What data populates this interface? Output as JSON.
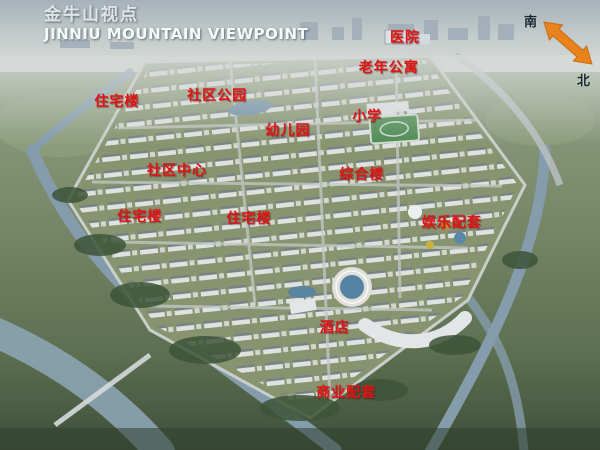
{
  "title": {
    "zh": "金牛山视点",
    "en": "JINNIU MOUNTAIN VIEWPOINT"
  },
  "compass": {
    "south": "南",
    "north": "北",
    "arrow_color": "#e8821c"
  },
  "labels": [
    {
      "id": "hospital",
      "text": "医院"
    },
    {
      "id": "senior-apartments",
      "text": "老年公寓"
    },
    {
      "id": "residential-northwest",
      "text": "住宅楼"
    },
    {
      "id": "community-park",
      "text": "社区公园"
    },
    {
      "id": "kindergarten",
      "text": "幼儿园"
    },
    {
      "id": "primary-school",
      "text": "小学"
    },
    {
      "id": "community-center",
      "text": "社区中心"
    },
    {
      "id": "mixed-use-building",
      "text": "综合楼"
    },
    {
      "id": "residential-west",
      "text": "住宅楼"
    },
    {
      "id": "residential-center",
      "text": "住宅楼"
    },
    {
      "id": "entertainment-facilities",
      "text": "娱乐配套"
    },
    {
      "id": "hotel",
      "text": "酒店"
    },
    {
      "id": "commercial-facilities",
      "text": "商业配套"
    }
  ],
  "colors": {
    "label_red": "#e01414",
    "title_white": "#f7fafb",
    "compass_text_dark": "#16262e",
    "water": "#849cab",
    "site_green": "#87946f"
  }
}
